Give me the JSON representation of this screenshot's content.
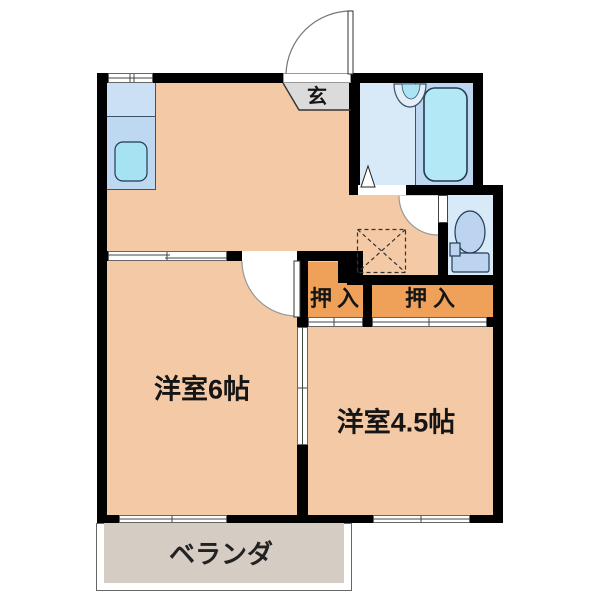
{
  "floorplan": {
    "labels": {
      "entrance": "玄",
      "room_6": "洋室6帖",
      "room_45": "洋室4.5帖",
      "closet_left": "押入",
      "closet_right": "押入",
      "veranda": "ベランダ"
    },
    "fixtures": [
      "entrance-swing-door",
      "kitchen-counter",
      "kitchen-sink",
      "bathtub",
      "washbasin",
      "bathroom-folding-door",
      "toilet",
      "toilet-swing-door",
      "washing-machine-space",
      "room6-swing-door",
      "sliding-door-between-rooms",
      "closet-sliding-doors",
      "windows"
    ],
    "colors": {
      "wall": "#000000",
      "room_floor": "#F4C9A5",
      "closet_fill": "#F0A159",
      "wet_floor": "#D8E9F8",
      "tub_deck": "#BCD7EF",
      "water_cyan": "#ABE4F2",
      "fixture_blue": "#BCD4F0",
      "counter_blue": "#BDD8F0",
      "entrance_gray": "#DBDBDB",
      "veranda_gray": "#D5CCC4"
    }
  }
}
